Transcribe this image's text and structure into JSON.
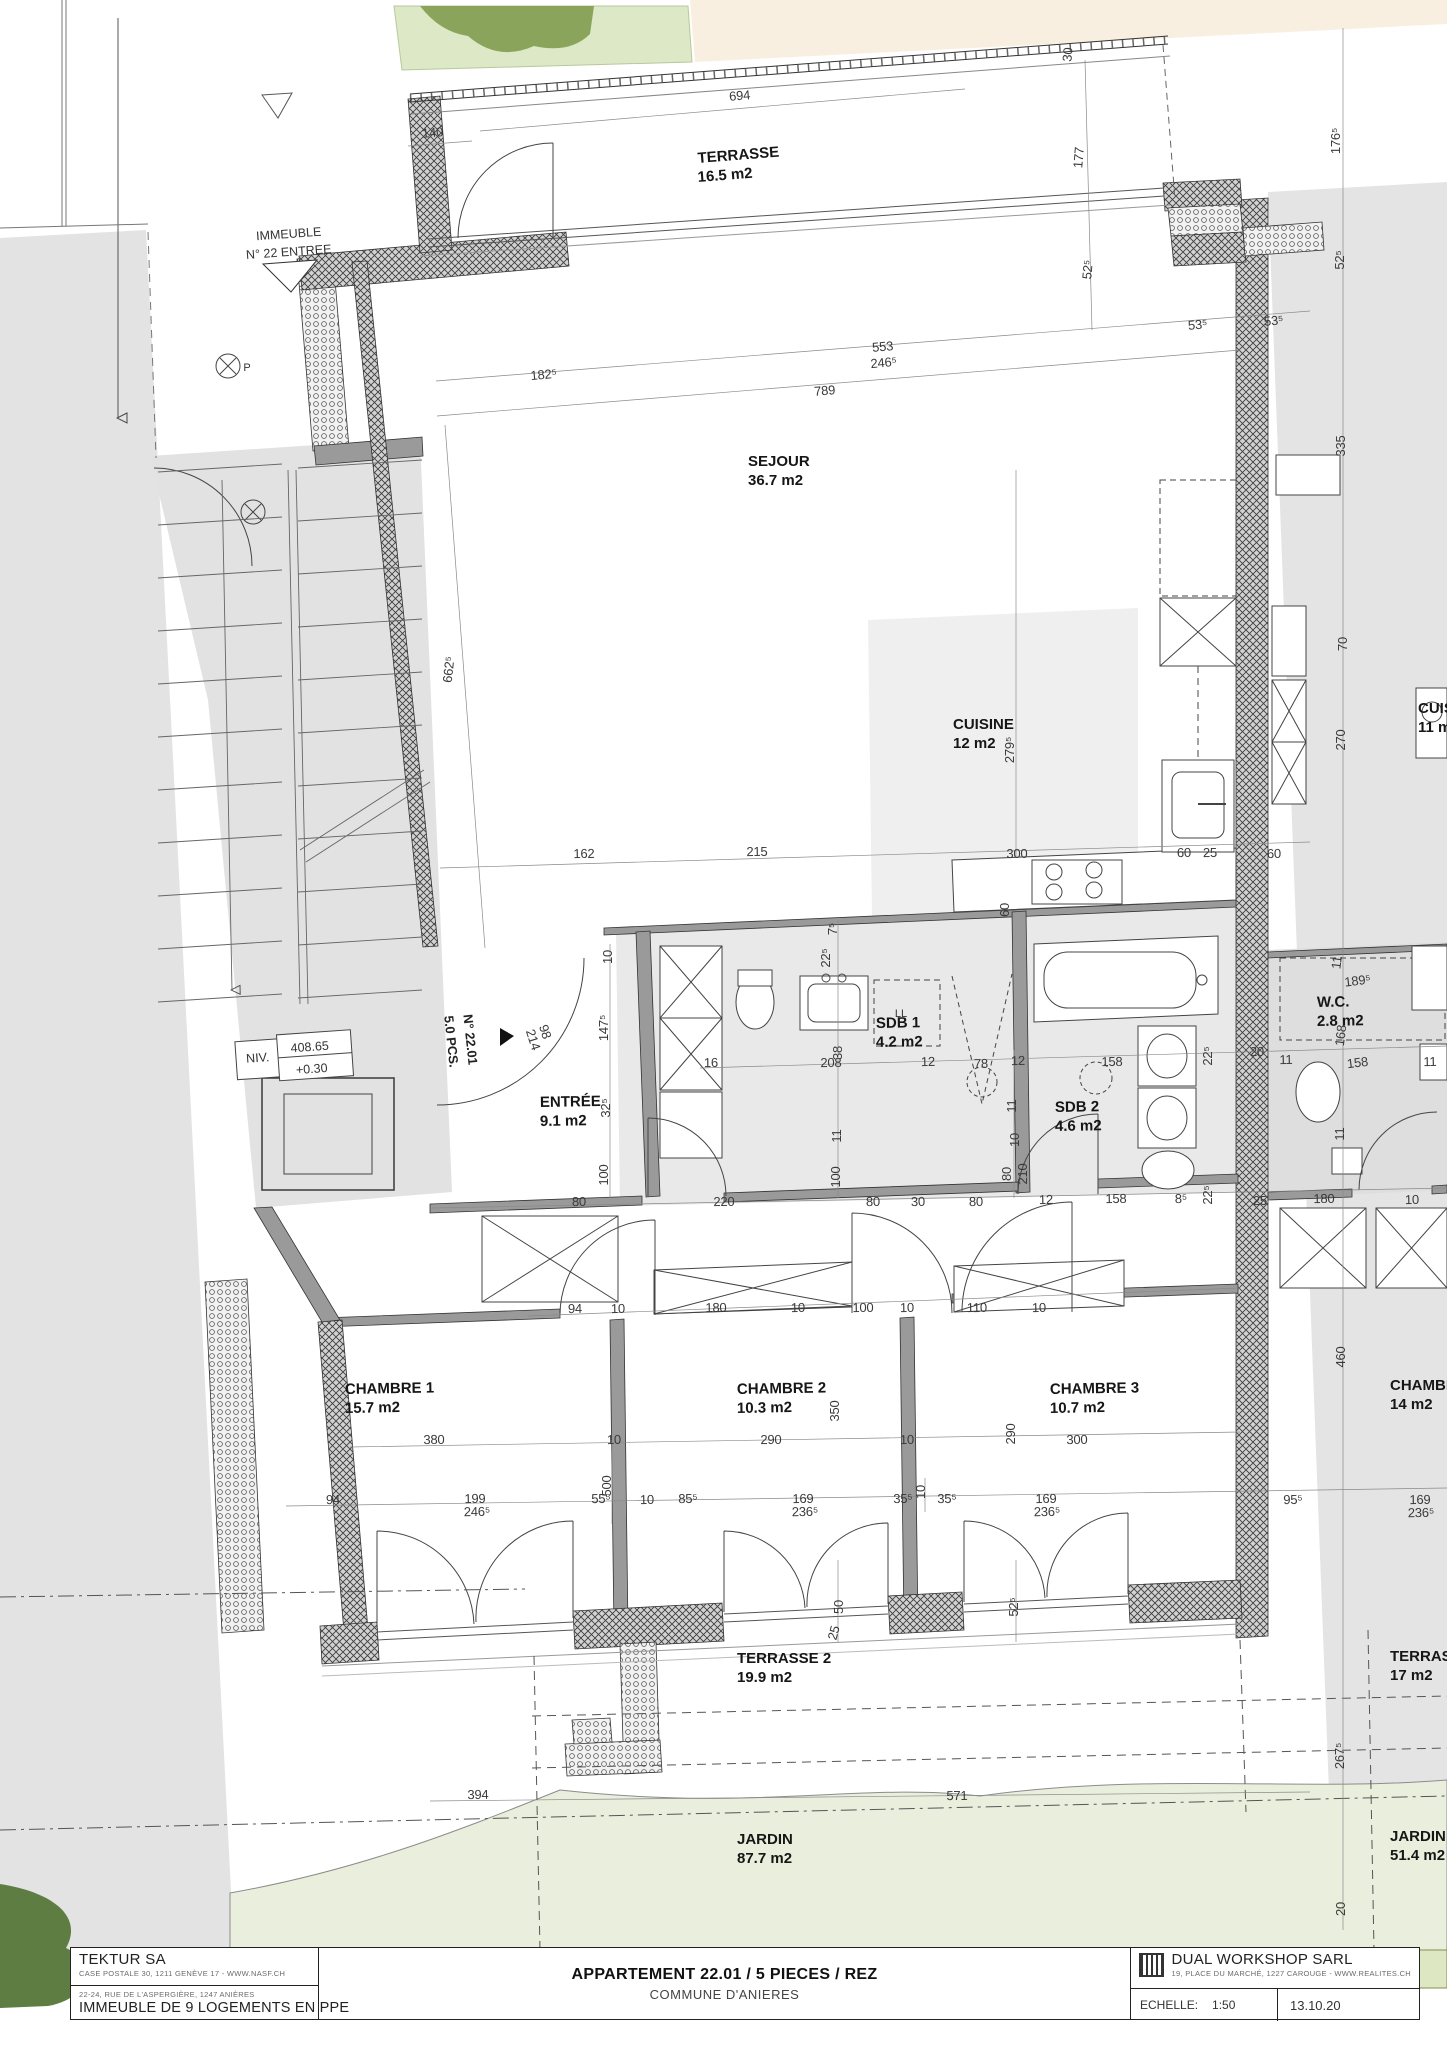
{
  "plan": {
    "rooms": [
      {
        "name": "TERRASSE",
        "area": "16.5 m2",
        "x": 698,
        "y": 163,
        "rot": -4.5
      },
      {
        "name": "SEJOUR",
        "area": "36.7 m2",
        "x": 748,
        "y": 466,
        "rot": 0
      },
      {
        "name": "CUISINE",
        "area": "12 m2",
        "x": 953,
        "y": 729,
        "rot": 0
      },
      {
        "name": "ENTRÉE",
        "area": "9.1 m2",
        "x": 540,
        "y": 1107,
        "rot": -1
      },
      {
        "name": "SDB 1",
        "area": "4.2 m2",
        "x": 876,
        "y": 1028,
        "rot": -1
      },
      {
        "name": "SDB 2",
        "area": "4.6 m2",
        "x": 1055,
        "y": 1112,
        "rot": -1
      },
      {
        "name": "W.C.",
        "area": "2.8 m2",
        "x": 1317,
        "y": 1007,
        "rot": -1
      },
      {
        "name": "CHAMBRE 1",
        "area": "15.7 m2",
        "x": 345,
        "y": 1394,
        "rot": -1
      },
      {
        "name": "CHAMBRE 2",
        "area": "10.3 m2",
        "x": 737,
        "y": 1394,
        "rot": -1
      },
      {
        "name": "CHAMBRE 3",
        "area": "10.7 m2",
        "x": 1050,
        "y": 1394,
        "rot": -1
      },
      {
        "name": "TERRASSE 2",
        "area": "19.9 m2",
        "x": 737,
        "y": 1663,
        "rot": 0
      },
      {
        "name": "JARDIN",
        "area": "87.7 m2",
        "x": 737,
        "y": 1844,
        "rot": 0
      },
      {
        "name": "CHAMBRE",
        "area": "14 m2",
        "x": 1390,
        "y": 1390,
        "rot": 0
      },
      {
        "name": "TERRASSE",
        "area": "17 m2",
        "x": 1390,
        "y": 1661,
        "rot": 0
      },
      {
        "name": "JARDIN",
        "area": "51.4 m2",
        "x": 1390,
        "y": 1841,
        "rot": 0
      },
      {
        "name": "CUISINE",
        "area": "11 m2",
        "x": 1418,
        "y": 713,
        "rot": 0
      }
    ],
    "dimensions_cm": [
      {
        "t": "694",
        "x": 740,
        "y": 100,
        "r": -5
      },
      {
        "t": "140",
        "x": 433,
        "y": 137,
        "r": -5
      },
      {
        "t": "177",
        "x": 1083,
        "y": 158,
        "r": -85
      },
      {
        "t": "176⁵",
        "x": 1340,
        "y": 141,
        "r": -90
      },
      {
        "t": "30",
        "x": 1072,
        "y": 55,
        "r": -85
      },
      {
        "t": "52⁵",
        "x": 1092,
        "y": 270,
        "r": -85
      },
      {
        "t": "52⁵",
        "x": 1344,
        "y": 260,
        "r": -90
      },
      {
        "t": "53⁵",
        "x": 1198,
        "y": 329,
        "r": -5
      },
      {
        "t": "53⁵",
        "x": 1274,
        "y": 325,
        "r": -5
      },
      {
        "t": "182⁵",
        "x": 544,
        "y": 379,
        "r": -5
      },
      {
        "t": "553",
        "x": 883,
        "y": 351,
        "r": -5
      },
      {
        "t": "246⁵",
        "x": 884,
        "y": 367,
        "r": -5
      },
      {
        "t": "789",
        "x": 825,
        "y": 395,
        "r": -5
      },
      {
        "t": "335",
        "x": 1345,
        "y": 446,
        "r": -90
      },
      {
        "t": "662⁵",
        "x": 453,
        "y": 670,
        "r": -84
      },
      {
        "t": "70",
        "x": 1347,
        "y": 644,
        "r": -90
      },
      {
        "t": "270",
        "x": 1345,
        "y": 740,
        "r": -90
      },
      {
        "t": "279⁵",
        "x": 1014,
        "y": 750,
        "r": -90
      },
      {
        "t": "162",
        "x": 584,
        "y": 858,
        "r": -1
      },
      {
        "t": "215",
        "x": 757,
        "y": 856,
        "r": -1
      },
      {
        "t": "300",
        "x": 1017,
        "y": 858,
        "r": -1
      },
      {
        "t": "60",
        "x": 1184,
        "y": 857,
        "r": -1
      },
      {
        "t": "25",
        "x": 1210,
        "y": 857,
        "r": -1
      },
      {
        "t": "60",
        "x": 1274,
        "y": 858,
        "r": -1
      },
      {
        "t": "60",
        "x": 1009,
        "y": 910,
        "r": -90
      },
      {
        "t": "7⁵",
        "x": 837,
        "y": 929,
        "r": -90
      },
      {
        "t": "22⁵",
        "x": 830,
        "y": 958,
        "r": -90
      },
      {
        "t": "10",
        "x": 612,
        "y": 957,
        "r": -90
      },
      {
        "t": "147⁵",
        "x": 608,
        "y": 1028,
        "r": -90
      },
      {
        "t": "98",
        "x": 541,
        "y": 1033,
        "r": 72
      },
      {
        "t": "214",
        "x": 529,
        "y": 1041,
        "r": 72
      },
      {
        "t": "16",
        "x": 711,
        "y": 1067,
        "r": -1
      },
      {
        "t": "208",
        "x": 831,
        "y": 1067,
        "r": -1
      },
      {
        "t": "38",
        "x": 842,
        "y": 1053,
        "r": -90
      },
      {
        "t": "12",
        "x": 928,
        "y": 1066,
        "r": -1
      },
      {
        "t": "78",
        "x": 981,
        "y": 1068,
        "r": -1
      },
      {
        "t": "12",
        "x": 1018,
        "y": 1065,
        "r": -1
      },
      {
        "t": "158",
        "x": 1112,
        "y": 1066,
        "r": -1
      },
      {
        "t": "22⁵",
        "x": 1212,
        "y": 1056,
        "r": -90
      },
      {
        "t": "20",
        "x": 1257,
        "y": 1056,
        "r": -1
      },
      {
        "t": "11",
        "x": 1286,
        "y": 1064,
        "r": -1
      },
      {
        "t": "189⁵",
        "x": 1358,
        "y": 985,
        "r": -7
      },
      {
        "t": "11",
        "x": 1341,
        "y": 963,
        "r": -83
      },
      {
        "t": "168",
        "x": 1345,
        "y": 1036,
        "r": -83
      },
      {
        "t": "158",
        "x": 1358,
        "y": 1067,
        "r": -7
      },
      {
        "t": "11",
        "x": 1430,
        "y": 1066,
        "r": -1
      },
      {
        "t": "32⁵",
        "x": 610,
        "y": 1108,
        "r": -90
      },
      {
        "t": "11",
        "x": 841,
        "y": 1136,
        "r": -90
      },
      {
        "t": "100",
        "x": 608,
        "y": 1175,
        "r": -90
      },
      {
        "t": "100",
        "x": 840,
        "y": 1177,
        "r": -90
      },
      {
        "t": "11",
        "x": 1016,
        "y": 1106,
        "r": -90
      },
      {
        "t": "10",
        "x": 1019,
        "y": 1140,
        "r": -90
      },
      {
        "t": "80",
        "x": 1011,
        "y": 1174,
        "r": -90
      },
      {
        "t": "210",
        "x": 1027,
        "y": 1174,
        "r": -90
      },
      {
        "t": "11",
        "x": 1344,
        "y": 1134,
        "r": -90
      },
      {
        "t": "80",
        "x": 579,
        "y": 1206,
        "r": -1
      },
      {
        "t": "220",
        "x": 724,
        "y": 1206,
        "r": -1
      },
      {
        "t": "80",
        "x": 873,
        "y": 1206,
        "r": -1
      },
      {
        "t": "30",
        "x": 918,
        "y": 1206,
        "r": -1
      },
      {
        "t": "80",
        "x": 976,
        "y": 1206,
        "r": -1
      },
      {
        "t": "12",
        "x": 1046,
        "y": 1204,
        "r": -1
      },
      {
        "t": "158",
        "x": 1116,
        "y": 1203,
        "r": -1
      },
      {
        "t": "8⁵",
        "x": 1181,
        "y": 1203,
        "r": -1
      },
      {
        "t": "22⁵",
        "x": 1212,
        "y": 1195,
        "r": -90
      },
      {
        "t": "25",
        "x": 1260,
        "y": 1205,
        "r": -1
      },
      {
        "t": "180",
        "x": 1324,
        "y": 1203,
        "r": -1
      },
      {
        "t": "10",
        "x": 1412,
        "y": 1204,
        "r": -1
      },
      {
        "t": "94",
        "x": 575,
        "y": 1313,
        "r": -1
      },
      {
        "t": "10",
        "x": 618,
        "y": 1313,
        "r": -1
      },
      {
        "t": "180",
        "x": 716,
        "y": 1312,
        "r": -1
      },
      {
        "t": "10",
        "x": 798,
        "y": 1312,
        "r": -1
      },
      {
        "t": "100",
        "x": 863,
        "y": 1312,
        "r": -1
      },
      {
        "t": "10",
        "x": 907,
        "y": 1312,
        "r": -1
      },
      {
        "t": "110",
        "x": 977,
        "y": 1312,
        "r": -1
      },
      {
        "t": "10",
        "x": 1039,
        "y": 1312,
        "r": -1
      },
      {
        "t": "460",
        "x": 1345,
        "y": 1357,
        "r": -90
      },
      {
        "t": "350",
        "x": 839,
        "y": 1411,
        "r": -90
      },
      {
        "t": "290",
        "x": 1015,
        "y": 1434,
        "r": -90
      },
      {
        "t": "380",
        "x": 434,
        "y": 1444,
        "r": -1
      },
      {
        "t": "10",
        "x": 614,
        "y": 1444,
        "r": -1
      },
      {
        "t": "290",
        "x": 771,
        "y": 1444,
        "r": -1
      },
      {
        "t": "10",
        "x": 907,
        "y": 1444,
        "r": -1
      },
      {
        "t": "300",
        "x": 1077,
        "y": 1444,
        "r": -1
      },
      {
        "t": "500",
        "x": 611,
        "y": 1486,
        "r": -90
      },
      {
        "t": "94",
        "x": 333,
        "y": 1504,
        "r": -1
      },
      {
        "t": "199",
        "x": 475,
        "y": 1503,
        "r": -1
      },
      {
        "t": "246⁵",
        "x": 477,
        "y": 1516,
        "r": -1
      },
      {
        "t": "55⁵",
        "x": 601,
        "y": 1503,
        "r": -1
      },
      {
        "t": "10",
        "x": 647,
        "y": 1504,
        "r": -1
      },
      {
        "t": "85⁵",
        "x": 688,
        "y": 1503,
        "r": -1
      },
      {
        "t": "169",
        "x": 803,
        "y": 1503,
        "r": -1
      },
      {
        "t": "236⁵",
        "x": 805,
        "y": 1516,
        "r": -1
      },
      {
        "t": "35⁵",
        "x": 903,
        "y": 1503,
        "r": -1
      },
      {
        "t": "10",
        "x": 925,
        "y": 1492,
        "r": -90
      },
      {
        "t": "35⁵",
        "x": 947,
        "y": 1503,
        "r": -1
      },
      {
        "t": "169",
        "x": 1046,
        "y": 1503,
        "r": -1
      },
      {
        "t": "236⁵",
        "x": 1047,
        "y": 1516,
        "r": -1
      },
      {
        "t": "95⁵",
        "x": 1293,
        "y": 1504,
        "r": -1
      },
      {
        "t": "169",
        "x": 1420,
        "y": 1504,
        "r": -1
      },
      {
        "t": "236⁵",
        "x": 1421,
        "y": 1517,
        "r": -1
      },
      {
        "t": "50",
        "x": 843,
        "y": 1607,
        "r": -90
      },
      {
        "t": "52⁵",
        "x": 1018,
        "y": 1607,
        "r": -90
      },
      {
        "t": "25",
        "x": 838,
        "y": 1634,
        "r": -75
      },
      {
        "t": "267⁵",
        "x": 1344,
        "y": 1756,
        "r": -90
      },
      {
        "t": "394",
        "x": 478,
        "y": 1799,
        "r": -1
      },
      {
        "t": "571",
        "x": 957,
        "y": 1800,
        "r": -1
      },
      {
        "t": "20",
        "x": 1345,
        "y": 1909,
        "r": -90
      }
    ],
    "notes": [
      {
        "t": "IMMEUBLE",
        "x": 289,
        "y": 238,
        "r": -4,
        "c": "note"
      },
      {
        "t": "N° 22 ENTREE",
        "x": 289,
        "y": 256,
        "r": -4,
        "c": "note"
      },
      {
        "t": "NIV.",
        "x": 258,
        "y": 1062,
        "r": -4,
        "c": "note"
      },
      {
        "t": "408.65",
        "x": 310,
        "y": 1051,
        "r": -4,
        "c": "note"
      },
      {
        "t": "+0.30",
        "x": 312,
        "y": 1073,
        "r": -4,
        "c": "note"
      },
      {
        "t": "5.0 PCS.",
        "x": 447,
        "y": 1042,
        "r": 84,
        "c": "note-b"
      },
      {
        "t": "N° 22.01",
        "x": 466,
        "y": 1040,
        "r": 84,
        "c": "note-b"
      },
      {
        "t": "LL",
        "x": 901,
        "y": 1017,
        "r": 0,
        "c": "small"
      },
      {
        "t": "P",
        "x": 247,
        "y": 371,
        "r": 0,
        "c": "small"
      }
    ]
  },
  "title_block": {
    "architect": {
      "name": "TEKTUR SA",
      "address": "CASE POSTALE 30, 1211 GENÈVE 17 - WWW.NASF.CH",
      "project_address": "22-24, RUE DE L'ASPERGIÈRE, 1247 ANIÈRES",
      "project_name": "IMMEUBLE DE 9 LOGEMENTS EN PPE"
    },
    "sheet": {
      "title": "APPARTEMENT 22.01 / 5 PIECES / REZ",
      "subtitle": "COMMUNE D'ANIERES"
    },
    "office": {
      "name": "DUAL WORKSHOP SARL",
      "address": "19, PLACE DU MARCHÉ, 1227 CAROUGE - WWW.REALITES.CH",
      "scale_label": "ECHELLE:",
      "scale": "1:50",
      "date": "13.10.20"
    }
  }
}
